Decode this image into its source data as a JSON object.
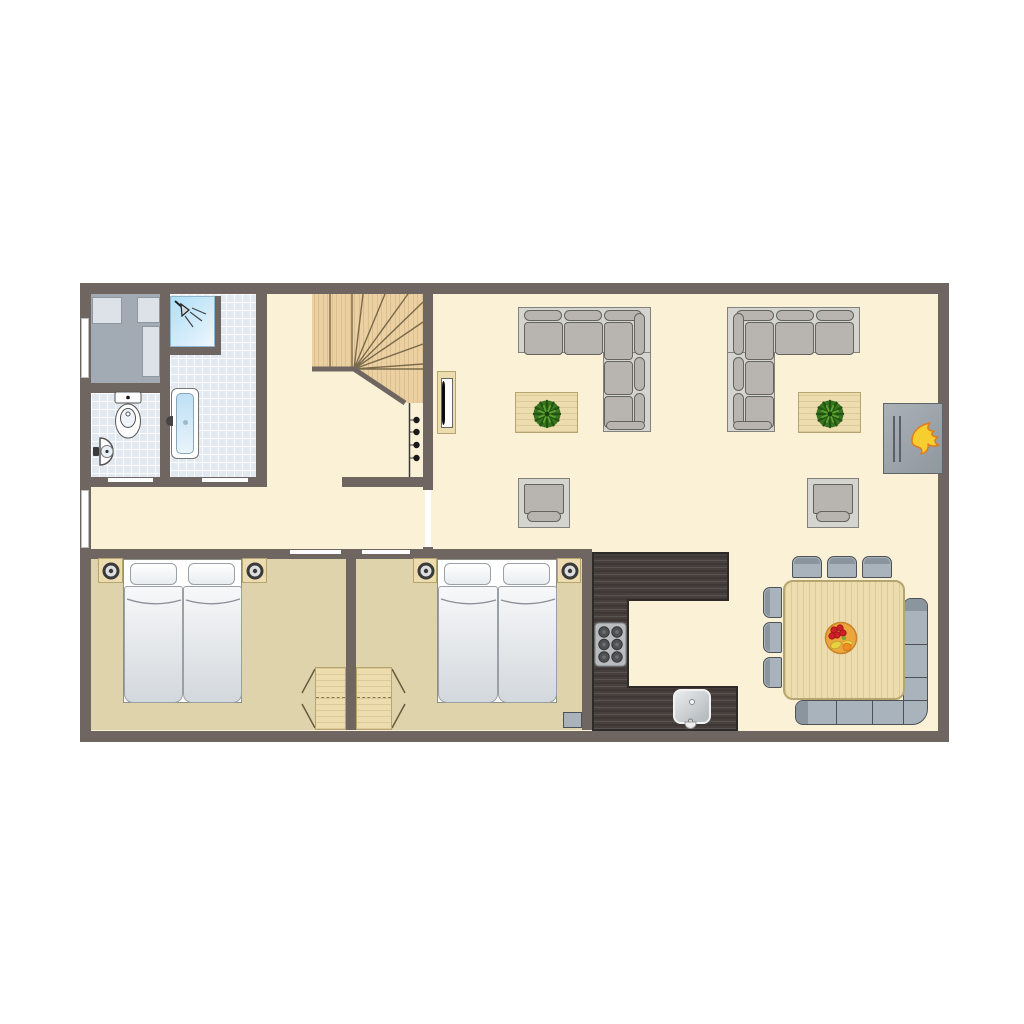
{
  "meta": {
    "type": "floor-plan",
    "description": "Ground-floor plan of a holiday home, top-down view, no text labels"
  },
  "colors": {
    "wall": "#6F6662",
    "floor_living": "#FBF1D7",
    "floor_bedroom": "#DFD3AB",
    "floor_tile": "#E2E9F0",
    "floor_utility": "#A2ABB3",
    "appliance": "#DCE2E7",
    "wood_light": "#ECDCAE",
    "wood_border": "#B7A570",
    "wood_stairs": "#EBD0A1",
    "stairs_line": "#6F6048",
    "counter_dark": "#463F3C",
    "counter_line": "#2E2A28",
    "gray_blue": "#A9B3BC",
    "gray_blue_dark": "#8B959E",
    "outline_dark": "#4E5156",
    "sofa_frame": "#D5D5CF",
    "sofa_cushion": "#B8B5B0",
    "sofa_line": "#65635F",
    "bed_white": "#FFFFFF",
    "mattress_top": "#F7F8F9",
    "mattress_bottom": "#D3D8DD",
    "bed_line": "#9AA0A5",
    "plant_green": "#39741F",
    "plant_dark": "#225414",
    "plant_light": "#5EA32E",
    "flame_yellow": "#F7CE2F",
    "flame_orange": "#E07C1C",
    "fireplace_gray": "#9BA3AB",
    "tub_blue": "#C9E4F6",
    "shower_blue": "#BFE0F4",
    "fruit_bowl": "#EDA63E",
    "fruit_red": "#CC2127",
    "fruit_yellow": "#F0DA4A",
    "fruit_orange": "#EF8F1F"
  },
  "rooms": [
    {
      "id": "utility-room",
      "furniture": [
        "storage-unit",
        "storage-unit",
        "storage-unit"
      ]
    },
    {
      "id": "toilet-room",
      "furniture": [
        "toilet",
        "hand-basin"
      ]
    },
    {
      "id": "bathroom",
      "furniture": [
        "shower",
        "bathtub"
      ]
    },
    {
      "id": "hallway",
      "furniture": [
        "winder-staircase",
        "coat-rack",
        "tv-cabinet"
      ]
    },
    {
      "id": "living-room",
      "furniture": [
        "corner-sofa",
        "corner-sofa",
        "coffee-table-with-plant",
        "coffee-table-with-plant",
        "armchair",
        "armchair",
        "fireplace"
      ]
    },
    {
      "id": "bedroom-1",
      "furniture": [
        "twin-bed",
        "twin-bed",
        "nightstand-with-lamp",
        "nightstand-with-lamp",
        "fold-down-table"
      ]
    },
    {
      "id": "bedroom-2",
      "furniture": [
        "twin-bed",
        "twin-bed",
        "nightstand-with-lamp",
        "nightstand-with-lamp",
        "fold-down-table",
        "stool"
      ]
    },
    {
      "id": "kitchen",
      "furniture": [
        "u-shaped-counter",
        "stove",
        "sink"
      ]
    },
    {
      "id": "dining-area",
      "furniture": [
        "dining-table",
        "dining-chair",
        "dining-chair",
        "dining-chair",
        "dining-chair",
        "dining-chair",
        "dining-chair",
        "corner-bench",
        "fruit-bowl"
      ]
    }
  ],
  "counts": {
    "coat_hooks": 4,
    "stove_burners": 6,
    "dining_chairs": 6,
    "windows": 2,
    "door_openings": 5,
    "beds_per_bedroom": 2
  }
}
